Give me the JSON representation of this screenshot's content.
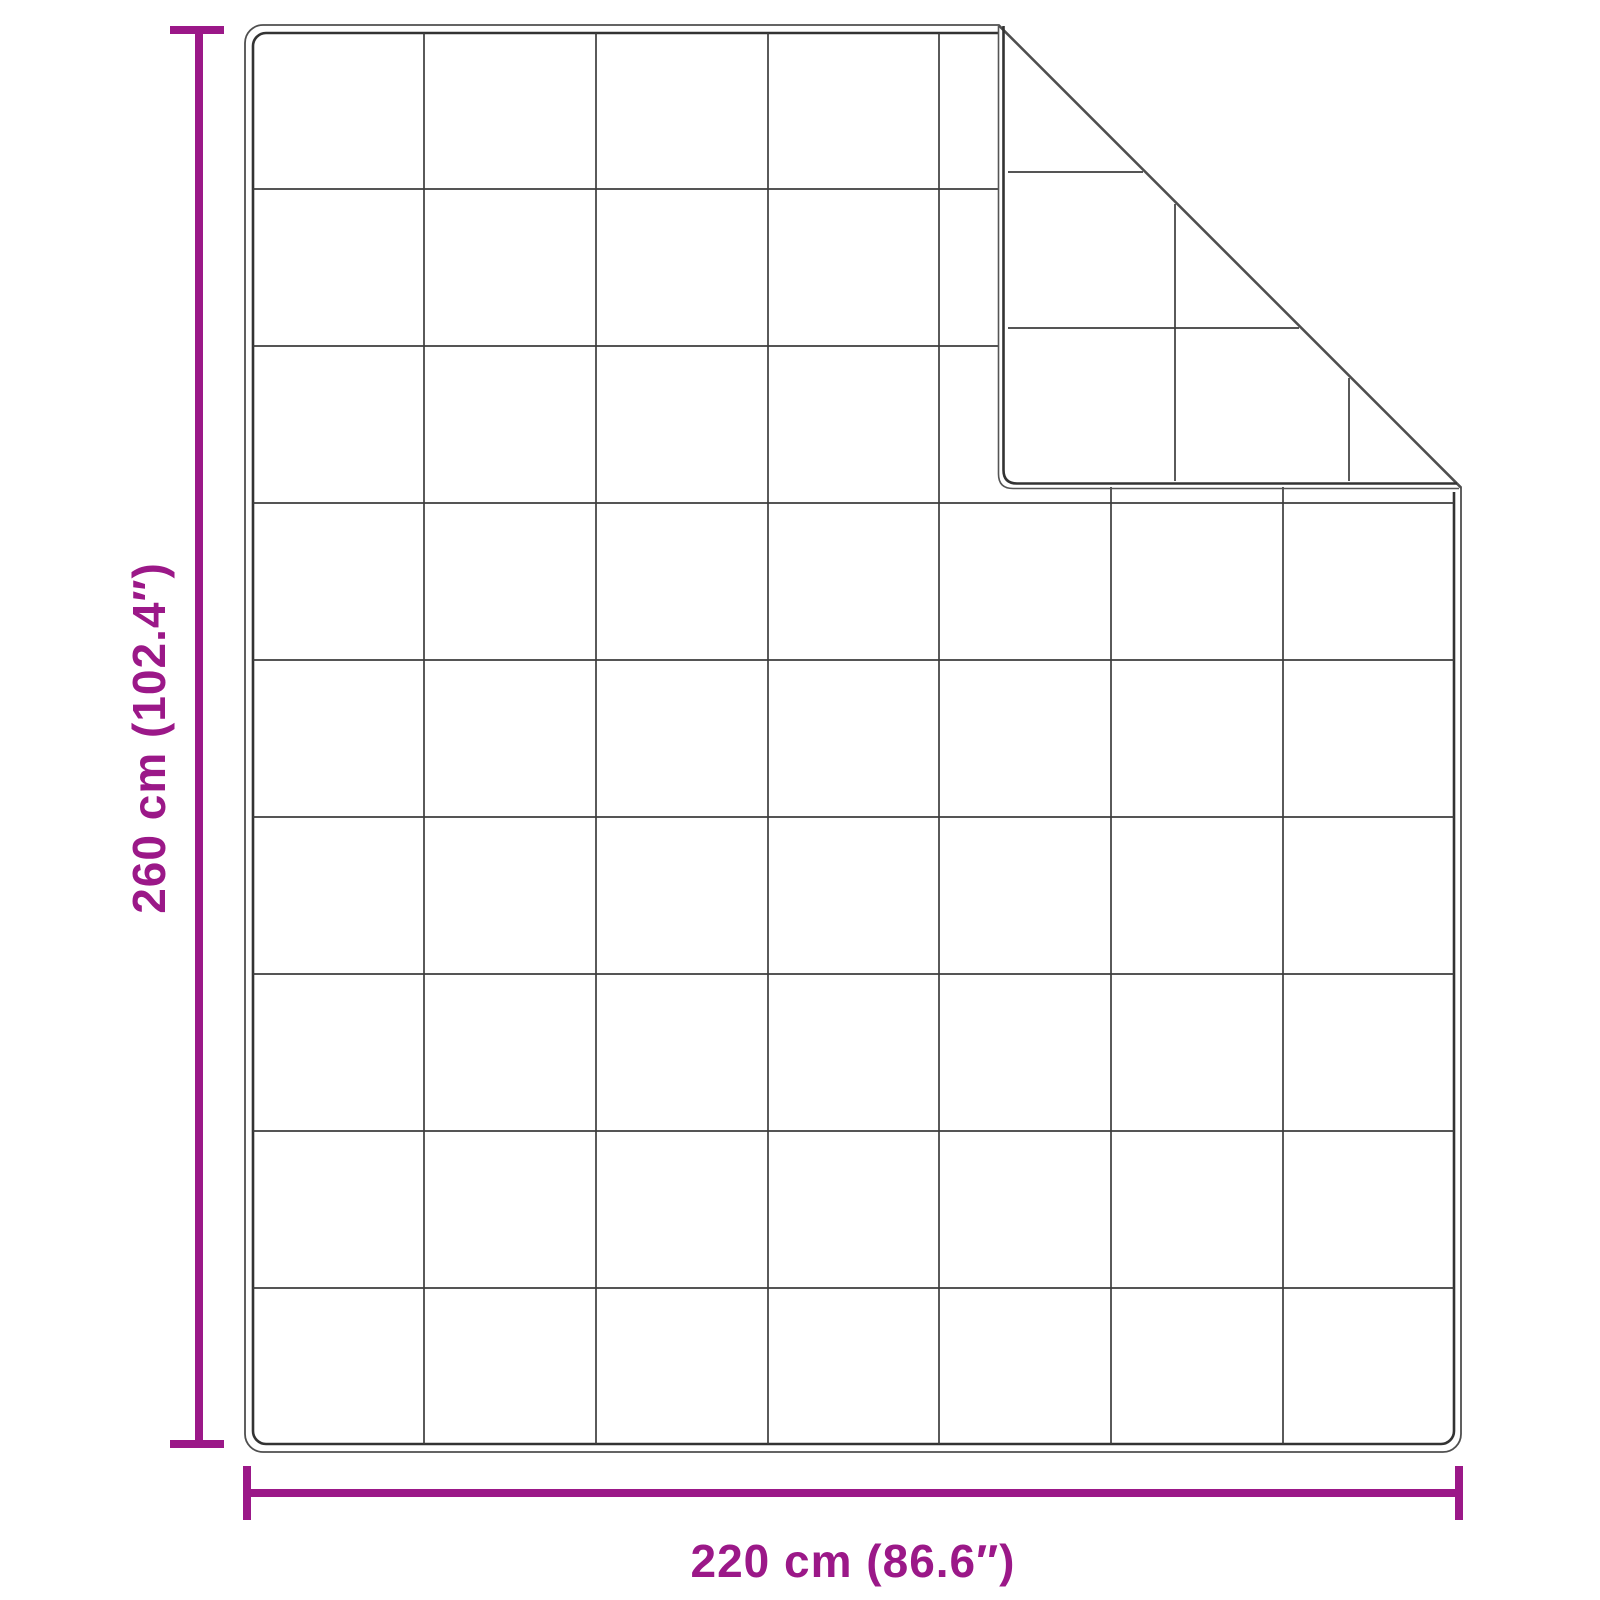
{
  "diagram": {
    "type": "blanket-dimension-diagram",
    "subject": "quilted blanket with folded top-right corner",
    "height_dimension": {
      "label": "260 cm (102.4″)",
      "value_cm": 260,
      "value_in": 102.4
    },
    "width_dimension": {
      "label": "220 cm (86.6″)",
      "value_cm": 220,
      "value_in": 86.6
    },
    "quilt_grid": {
      "columns": 7,
      "rows": 9,
      "folded_corner": "top-right"
    },
    "colors": {
      "dimension_accent": "#9B1888",
      "outline": "#4F4F4F",
      "stitch": "#333333",
      "grid_line": "#3D3D3D",
      "background": "#FFFFFF"
    }
  }
}
